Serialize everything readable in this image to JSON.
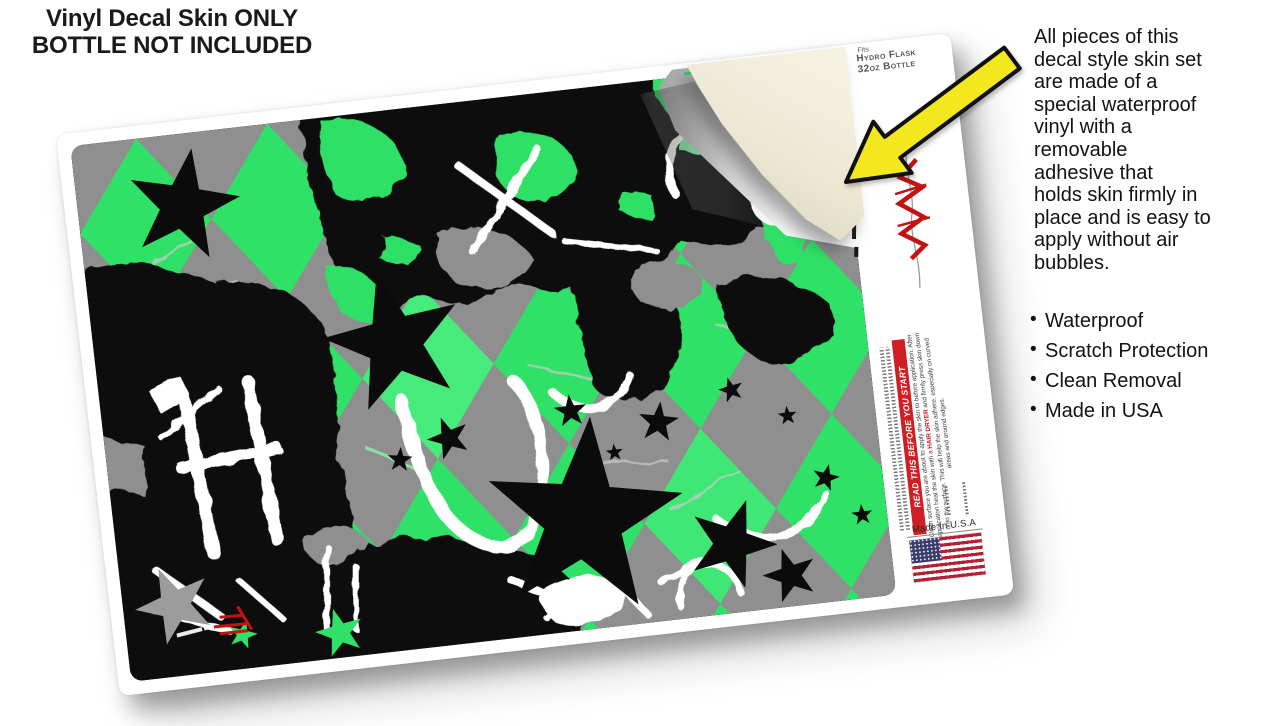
{
  "header": {
    "line1": "Vinyl Decal Skin ONLY",
    "line2": "BOTTLE NOT INCLUDED"
  },
  "info_panel": {
    "paragraph": "All pieces of this\ndecal style  skin set\nare made of a\nspecial waterproof\nvinyl with a\nremovable\nadhesive that\nholds skin firmly in\nplace and is easy to\napply without air\nbubbles.",
    "bullets": [
      "Waterproof",
      "Scratch Protection",
      "Clean Removal",
      "Made in USA"
    ]
  },
  "sheet": {
    "fits_label": {
      "line1": "Fits",
      "line2": "Hydro Flask",
      "line3": "32oz Bottle"
    },
    "warning_banner": "READ THIS BEFORE YOU START",
    "instructions": {
      "before": "Clean surface you are about to apply the skin to before application. After application heat the skin with a ",
      "highlight": "HAIR DRYER",
      "after": " and firmly press skin down onto the surface. This will help the skin adhere, especially on curved areas and around edges."
    },
    "made_in": "Made In U.S.A"
  },
  "icons": {
    "peel_arrow": "peel-arrow-icon",
    "us_flag": "us-flag-icon",
    "brand_logo": "wraptorskinz-logo-icon",
    "stars": "star-icon"
  },
  "colors": {
    "pattern_green": "#2FE166",
    "pattern_gray": "#8F8F8F",
    "pattern_black": "#0B0B0B",
    "arrow_yellow": "#F3E71E",
    "banner_red": "#D01F24",
    "logo_red": "#C41212",
    "backing_cream": "#EDE8D4",
    "kisscut_green": "#2BD964"
  }
}
